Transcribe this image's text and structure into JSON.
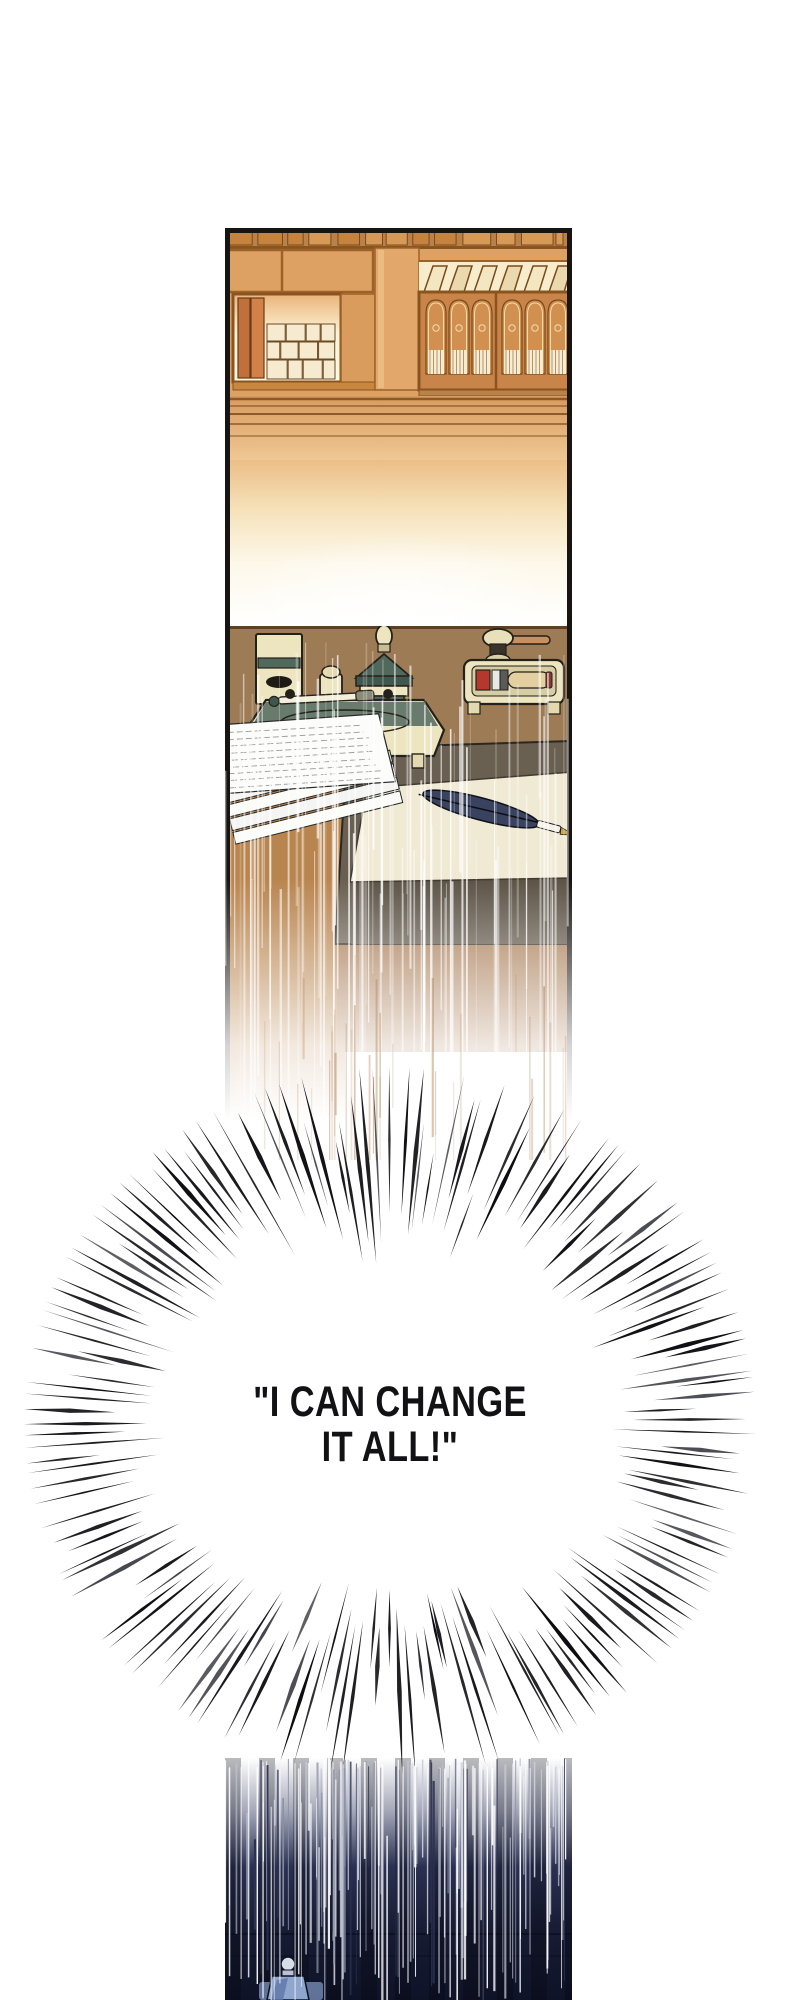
{
  "dialogue": {
    "line1": "\"I CAN CHANGE",
    "line2": "IT ALL!\""
  },
  "colors": {
    "background": "#ffffff",
    "panel_border": "#181411",
    "shelf_wood": "#dea164",
    "shelf_wood_dark": "#c9844a",
    "shelf_line": "#8a5420",
    "backlight_cream": "#fdf3d6",
    "book_cream": "#f6ead0",
    "desk_surface": "#9d7b55",
    "desk_side": "#b9854f",
    "desk_edge_dark": "#696051",
    "paper_cream": "#f0e9d3",
    "paper_white": "#fcfcfa",
    "inkstand_cream": "#ece5c0",
    "inkstand_teal": "#51695d",
    "wax_red": "#b5382e",
    "quill_navy": "#39435f",
    "burst_line": "#0d0d11",
    "dialogue_text": "#121215",
    "night_panel": "#171b33",
    "ink_bottle_blue": "#8fa7cf"
  }
}
